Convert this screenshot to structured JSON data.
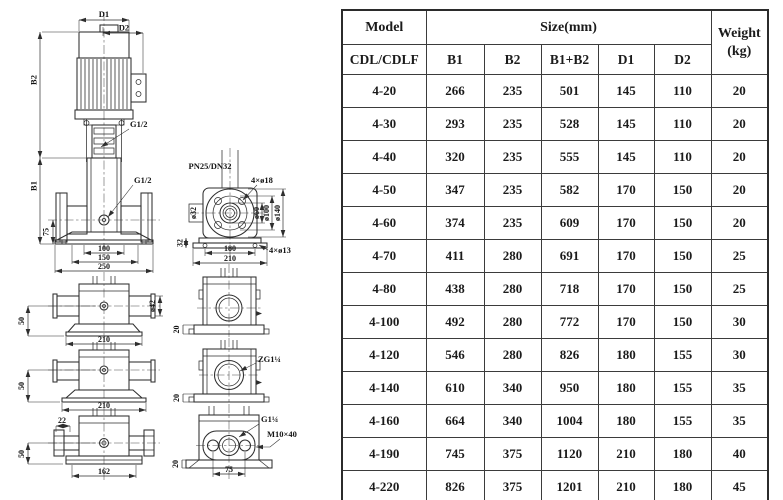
{
  "drawing": {
    "labels": {
      "d1": "D1",
      "d2": "D2",
      "b2": "B2",
      "b1": "B1",
      "g12_coupling": "G1/2",
      "g12_port": "G1/2",
      "dim75": "75",
      "dim100": "100",
      "dim150": "150",
      "dim250": "250",
      "pn": "PN25/DN32",
      "holes18": "4×ø18",
      "dia32": "ø32",
      "dia60": "ø60",
      "dia100": "ø100",
      "dia140": "ø140",
      "dim32": "32",
      "dim180": "180",
      "dim210": "210",
      "holes13": "4×ø13",
      "bv1_50": "50",
      "bv1_210": "210",
      "dia42": "ø42",
      "bv2_50": "50",
      "bv2_210": "210",
      "bv3_22": "22",
      "bv3_50": "50",
      "bv3_162": "162",
      "sv1_20": "20",
      "sv2_20": "20",
      "zg": "ZG1¼",
      "g114": "G1¼",
      "m10": "M10×40",
      "botv_20": "20",
      "botv_75": "75"
    }
  },
  "table": {
    "header": {
      "model": "Model",
      "model_sub": "CDL/CDLF",
      "size": "Size(mm)",
      "weight_line1": "Weight",
      "weight_line2": "(kg)",
      "size_cols": [
        "B1",
        "B2",
        "B1+B2",
        "D1",
        "D2"
      ]
    },
    "rows": [
      [
        "4-20",
        "266",
        "235",
        "501",
        "145",
        "110",
        "20"
      ],
      [
        "4-30",
        "293",
        "235",
        "528",
        "145",
        "110",
        "20"
      ],
      [
        "4-40",
        "320",
        "235",
        "555",
        "145",
        "110",
        "20"
      ],
      [
        "4-50",
        "347",
        "235",
        "582",
        "170",
        "150",
        "20"
      ],
      [
        "4-60",
        "374",
        "235",
        "609",
        "170",
        "150",
        "20"
      ],
      [
        "4-70",
        "411",
        "280",
        "691",
        "170",
        "150",
        "25"
      ],
      [
        "4-80",
        "438",
        "280",
        "718",
        "170",
        "150",
        "25"
      ],
      [
        "4-100",
        "492",
        "280",
        "772",
        "170",
        "150",
        "30"
      ],
      [
        "4-120",
        "546",
        "280",
        "826",
        "180",
        "155",
        "30"
      ],
      [
        "4-140",
        "610",
        "340",
        "950",
        "180",
        "155",
        "35"
      ],
      [
        "4-160",
        "664",
        "340",
        "1004",
        "180",
        "155",
        "35"
      ],
      [
        "4-190",
        "745",
        "375",
        "1120",
        "210",
        "180",
        "40"
      ],
      [
        "4-220",
        "826",
        "375",
        "1201",
        "210",
        "180",
        "45"
      ]
    ]
  }
}
